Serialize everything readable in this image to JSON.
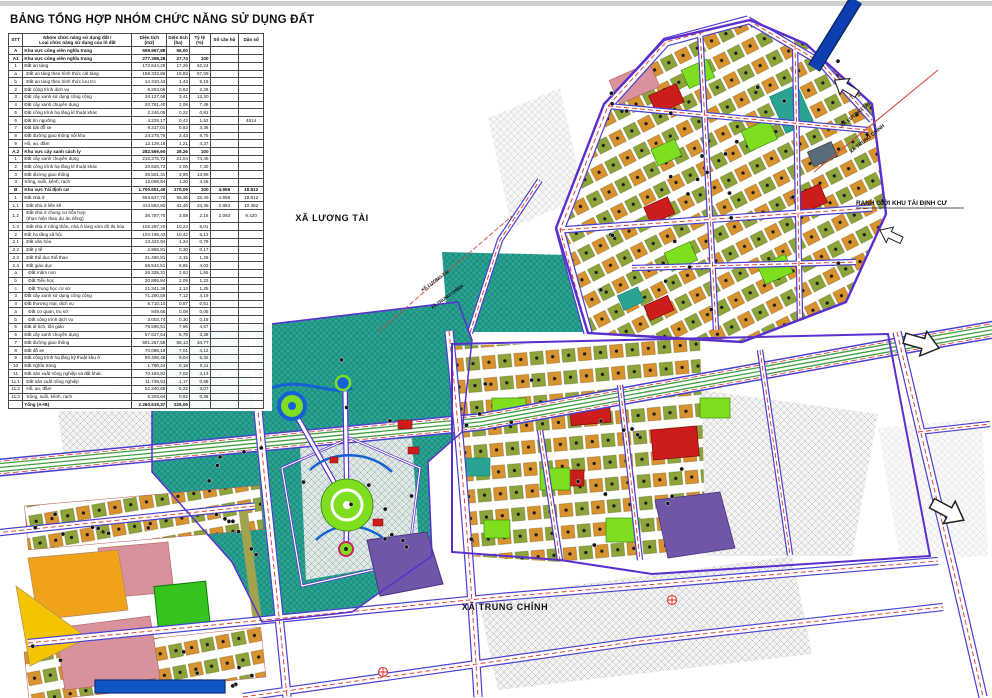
{
  "title": "BẢNG TỔNG HỢP NHÓM CHỨC NĂNG SỬ DỤNG ĐẤT",
  "table": {
    "headers": [
      "STT",
      "Nhóm chức năng sử dụng đất /\nLoại chức năng sử dụng của lô đất",
      "Diện tích\n(m2)",
      "Diện tích\n(ha)",
      "Tỷ lệ\n(%)",
      "Số căn hộ",
      "Dân số"
    ],
    "rows": [
      {
        "stt": "A",
        "name": "Khu vực công viên nghĩa trang",
        "m2": "559.967,88",
        "ha": "56,00",
        "pct": "",
        "units": "",
        "pop": "",
        "s": "g"
      },
      {
        "stt": "A1",
        "name": "Khu vực công viên nghĩa trang",
        "m2": "277.398,28",
        "ha": "27,74",
        "pct": "100",
        "units": "",
        "pop": "",
        "s": "g"
      },
      {
        "stt": "1",
        "name": "Đất an táng",
        "m2": "172.644,29",
        "ha": "17,26",
        "pct": "62,24",
        "units": "",
        "pop": "",
        "s": "m"
      },
      {
        "stt": "a",
        "name": "Đất an táng theo hình thức cát táng",
        "m2": "158.333,86",
        "ha": "15,83",
        "pct": "57,08",
        "units": "",
        "pop": "",
        "s": "i"
      },
      {
        "stt": "b",
        "name": "Đất an táng theo hình thức lưu tro",
        "m2": "14.310,43",
        "ha": "1,43",
        "pct": "5,16",
        "units": "",
        "pop": "",
        "s": "i"
      },
      {
        "stt": "2",
        "name": "Đất công trình dịch vụ",
        "m2": "6.263,06",
        "ha": "0,63",
        "pct": "2,26",
        "units": "",
        "pop": "",
        "s": "m"
      },
      {
        "stt": "3",
        "name": "Đất cây xanh sử dụng công cộng",
        "m2": "34.127,98",
        "ha": "3,41",
        "pct": "12,30",
        "units": "",
        "pop": "",
        "s": "m"
      },
      {
        "stt": "4",
        "name": "Đất cây xanh chuyên dụng",
        "m2": "20.761,40",
        "ha": "2,08",
        "pct": "7,48",
        "units": "",
        "pop": "",
        "s": "m"
      },
      {
        "stt": "5",
        "name": "Đất công trình hạ tầng kĩ thuật khác",
        "m2": "2.246,05",
        "ha": "0,22",
        "pct": "0,81",
        "units": "",
        "pop": "",
        "s": "m"
      },
      {
        "stt": "6",
        "name": "Đất tín ngưỡng",
        "m2": "4.229,17",
        "ha": "0,42",
        "pct": "1,52",
        "units": "",
        "pop": "4614",
        "s": "m"
      },
      {
        "stt": "7",
        "name": "Đất bãi đỗ xe",
        "m2": "9.317,01",
        "ha": "0,93",
        "pct": "3,36",
        "units": "",
        "pop": "",
        "s": "m"
      },
      {
        "stt": "8",
        "name": "Đất đường giao thông nội khu",
        "m2": "24.275,79",
        "ha": "2,43",
        "pct": "8,75",
        "units": "",
        "pop": "",
        "s": "m"
      },
      {
        "stt": "9",
        "name": "Hồ, ao, đầm",
        "m2": "12.129,18",
        "ha": "1,21",
        "pct": "4,37",
        "units": "",
        "pop": "",
        "s": "m"
      },
      {
        "stt": "A.2",
        "name": "Khu vực cây xanh cách ly",
        "m2": "282.569,60",
        "ha": "28,26",
        "pct": "100",
        "units": "",
        "pop": "",
        "s": "g"
      },
      {
        "stt": "1",
        "name": "Đất cây xanh chuyên dụng",
        "m2": "210.375,72",
        "ha": "21,04",
        "pct": "74,45",
        "units": "",
        "pop": "",
        "s": "m"
      },
      {
        "stt": "2",
        "name": "Đất công trình hạ tầng kĩ thuật khác",
        "m2": "20.620,73",
        "ha": "2,06",
        "pct": "7,30",
        "units": "",
        "pop": "",
        "s": "m"
      },
      {
        "stt": "3",
        "name": "Đất đường giao thông",
        "m2": "39.501,31",
        "ha": "3,95",
        "pct": "13,98",
        "units": "",
        "pop": "",
        "s": "m"
      },
      {
        "stt": "4",
        "name": "Sông, suối, kênh, rạch",
        "m2": "12.099,84",
        "ha": "1,20",
        "pct": "4,26",
        "units": "",
        "pop": "",
        "s": "m"
      },
      {
        "stt": "B",
        "name": "Khu vực Tái định cư",
        "m2": "1.700.651,49",
        "ha": "170,09",
        "pct": "100",
        "units": "4.956",
        "pop": "19.812",
        "s": "g"
      },
      {
        "stt": "1",
        "name": "Đất nhà ở",
        "m2": "553.647,70",
        "ha": "55,36",
        "pct": "32,49",
        "units": "4.956",
        "pop": "19.812",
        "s": "m"
      },
      {
        "stt": "1.1",
        "name": "Đất nhà ở liền kề",
        "m2": "414.562,80",
        "ha": "41,46",
        "pct": "24,38",
        "units": "2.863",
        "pop": "10.392",
        "s": "i"
      },
      {
        "stt": "1.2",
        "name": "Đất nhà ở chung cư hỗn hợp\n(thực hiện theo dự án riêng)",
        "m2": "36.787,70",
        "ha": "3,68",
        "pct": "2,16",
        "units": "2.093",
        "pop": "9.420",
        "s": "i"
      },
      {
        "stt": "1.3",
        "name": "Đất nhà ở nông thôn, nhà ở làng xóm đô thị hóa",
        "m2": "102.297,20",
        "ha": "10,23",
        "pct": "6,01",
        "units": "",
        "pop": "",
        "s": "i"
      },
      {
        "stt": "2",
        "name": "Đất hạ tầng xã hội",
        "m2": "104.198,43",
        "ha": "10,42",
        "pct": "6,13",
        "units": "",
        "pop": "",
        "s": "m"
      },
      {
        "stt": "2.1",
        "name": "Đất văn hóa",
        "m2": "13.422,94",
        "ha": "1,34",
        "pct": "0,79",
        "units": "",
        "pop": "",
        "s": "i"
      },
      {
        "stt": "2.2",
        "name": "Đất y tế",
        "m2": "2.968,81",
        "ha": "0,30",
        "pct": "0,17",
        "units": "",
        "pop": "",
        "s": "i"
      },
      {
        "stt": "2.3",
        "name": "Đất thể dục thể thao",
        "m2": "21.490,81",
        "ha": "2,15",
        "pct": "1,26",
        "units": "",
        "pop": "",
        "s": "i"
      },
      {
        "stt": "2.4",
        "name": "Đất giáo dục",
        "m2": "68.542,51",
        "ha": "6,85",
        "pct": "4,03",
        "units": "",
        "pop": "",
        "s": "i"
      },
      {
        "stt": "a",
        "name": "Đất mầm non",
        "m2": "26.335,31",
        "ha": "2,63",
        "pct": "1,55",
        "units": "",
        "pop": "",
        "s": "i2"
      },
      {
        "stt": "b",
        "name": "Đất Tiểu học",
        "m2": "20.865,84",
        "ha": "2,09",
        "pct": "1,23",
        "units": "",
        "pop": "",
        "s": "i2"
      },
      {
        "stt": "c",
        "name": "Đất Trung học cơ sở",
        "m2": "21.341,36",
        "ha": "2,13",
        "pct": "1,25",
        "units": "",
        "pop": "",
        "s": "i2"
      },
      {
        "stt": "3",
        "name": "Đất cây xanh sử dụng công cộng",
        "m2": "71.290,59",
        "ha": "7,12",
        "pct": "4,19",
        "units": "",
        "pop": "",
        "s": "m"
      },
      {
        "stt": "4",
        "name": "Đất thương mại, dịch vụ",
        "m2": "8.710,10",
        "ha": "0,87",
        "pct": "0,51",
        "units": "",
        "pop": "",
        "s": "m"
      },
      {
        "stt": "a",
        "name": "Đất cơ quan, trụ sở",
        "m2": "849,65",
        "ha": "0,08",
        "pct": "0,05",
        "units": "",
        "pop": "",
        "s": "i2"
      },
      {
        "stt": "b",
        "name": "Đất công trình dịch vụ",
        "m2": "3.003,74",
        "ha": "0,30",
        "pct": "0,18",
        "units": "",
        "pop": "",
        "s": "i2"
      },
      {
        "stt": "5",
        "name": "Đất di tích, tôn giáo",
        "m2": "79.590,51",
        "ha": "7,96",
        "pct": "4,67",
        "units": "",
        "pop": "",
        "s": "m"
      },
      {
        "stt": "6",
        "name": "Đất cây xanh chuyên dụng",
        "m2": "57.627,64",
        "ha": "5,76",
        "pct": "3,38",
        "units": "",
        "pop": "",
        "s": "m"
      },
      {
        "stt": "7",
        "name": "Đất đường giao thông",
        "m2": "591.267,58",
        "ha": "59,13",
        "pct": "34,77",
        "units": "",
        "pop": "",
        "s": "m"
      },
      {
        "stt": "8",
        "name": "Đất đỗ xe",
        "m2": "70.096,19",
        "ha": "7,01",
        "pct": "4,12",
        "units": "",
        "pop": "",
        "s": "m"
      },
      {
        "stt": "9",
        "name": "Đất công trình hạ tầng kỹ thuật khu ở",
        "m2": "90.406,48",
        "ha": "9,04",
        "pct": "5,32",
        "units": "",
        "pop": "",
        "s": "m"
      },
      {
        "stt": "10",
        "name": "Đất nghĩa trang",
        "m2": "1.790,24",
        "ha": "0,18",
        "pct": "0,11",
        "units": "",
        "pop": "",
        "s": "m"
      },
      {
        "stt": "11",
        "name": "Đất sản xuất nông nghiệp và đất khác",
        "m2": "70.183,82",
        "ha": "7,02",
        "pct": "4,13",
        "units": "",
        "pop": "",
        "s": "m"
      },
      {
        "stt": "11.1",
        "name": "Đất sản xuất nông nghiệp",
        "m2": "11.739,53",
        "ha": "1,17",
        "pct": "0,69",
        "units": "",
        "pop": "",
        "s": "i"
      },
      {
        "stt": "11.2",
        "name": "Hồ, ao, đầm",
        "m2": "52.240,65",
        "ha": "5,22",
        "pct": "3,07",
        "units": "",
        "pop": "",
        "s": "i"
      },
      {
        "stt": "11.3",
        "name": "Sông, suối, kênh, rạch",
        "m2": "6.203,64",
        "ha": "0,62",
        "pct": "0,36",
        "units": "",
        "pop": "",
        "s": "i"
      },
      {
        "stt": "",
        "name": "Tổng (A+B)",
        "m2": "2.260.619,37",
        "ha": "226,06",
        "pct": "",
        "units": "",
        "pop": "",
        "s": "t"
      }
    ]
  },
  "map": {
    "labels": {
      "commune_left": "XÃ LƯƠNG TÀI",
      "commune_bottom": "XÃ TRUNG CHÍNH",
      "boundary_note": "RANH GIỚI KHU TÁI ĐỊNH CƯ",
      "diag_tr_top": "XÃ LƯƠNG TÀI",
      "diag_tr_bottom": "XÃ TRUNG CHÍNH",
      "diag_c_top": "XÃ LƯƠNG TÀI",
      "diag_c_bottom": "XÃ TRUNG CHÍNH"
    },
    "colors": {
      "cemetery_teal": "#2aa392",
      "park_green": "#7ede1f",
      "service_red": "#cc1c1c",
      "housing_orange": "#d6932f",
      "housing_olive": "#8fa33b",
      "rural_pink": "#d9919b",
      "boundary_purple": "#5a2fd0",
      "road_center_red": "#e03030",
      "water_blue": "#0d3fb2",
      "mixed_purple": "#7055a8",
      "wedge_orange": "#f0a21a",
      "wedge_yellow": "#f5c400",
      "existing_gray": "#a8a8a8"
    }
  }
}
